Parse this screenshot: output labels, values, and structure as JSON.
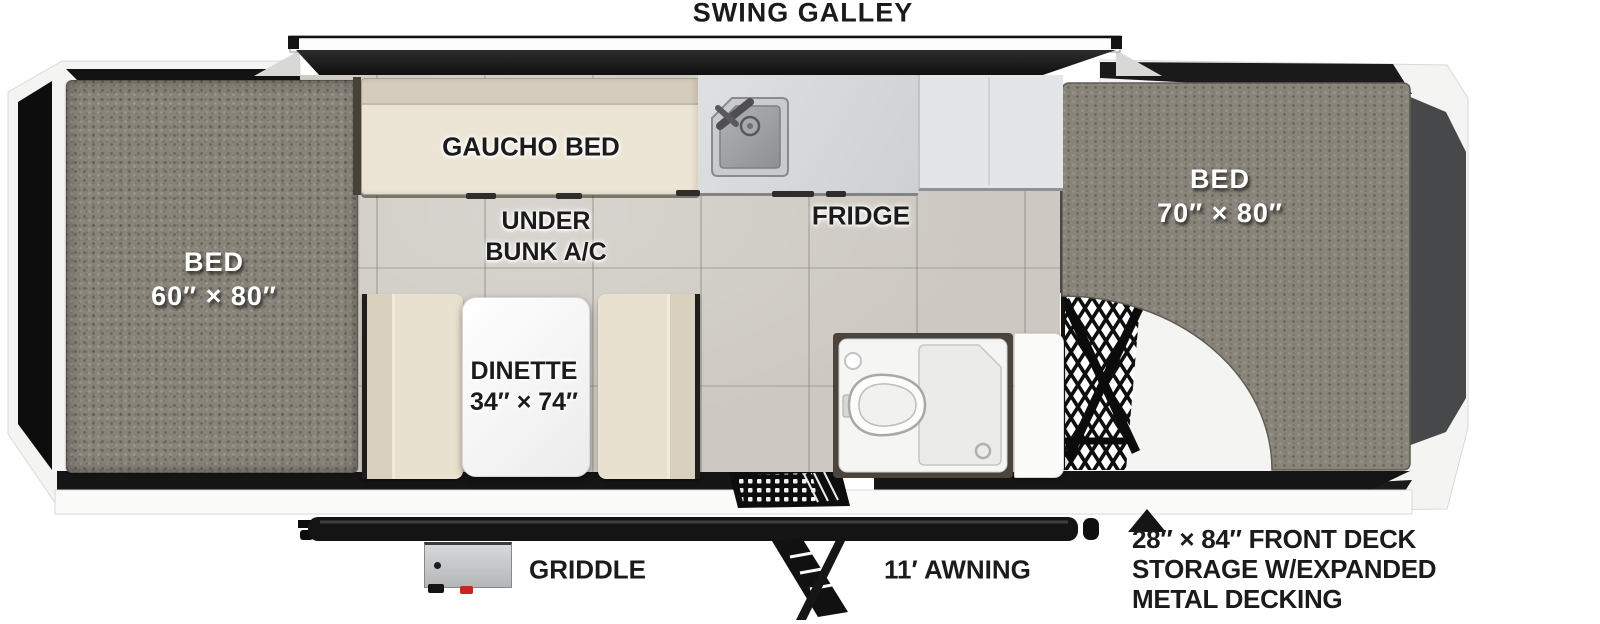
{
  "title": "SWING GALLEY",
  "labels": {
    "front_bed_name": "BED",
    "front_bed_size": "60″ × 80″",
    "rear_bed_name": "BED",
    "rear_bed_size": "70″ × 80″",
    "gaucho_bed": "GAUCHO BED",
    "under_bunk_line1": "UNDER",
    "under_bunk_line2": "BUNK A/C",
    "fridge": "FRIDGE",
    "dinette_name": "DINETTE",
    "dinette_size": "34″ × 74″",
    "griddle": "GRIDDLE",
    "awning": "11′ AWNING",
    "deck_note_line1": "28″ × 84″ FRONT DECK",
    "deck_note_line2": "STORAGE W/EXPANDED",
    "deck_note_line3": "METAL DECKING"
  },
  "icons": {
    "sink": "sink-icon",
    "toilet": "toilet-icon",
    "shower_pan": "shower-pan-icon",
    "entry_step": "entry-step-icon",
    "fold_step": "fold-step-icon",
    "awning_rail": "awning-rail",
    "mesh_decking": "expanded-metal-mesh",
    "note_arrow": "up-triangle-icon"
  },
  "colors": {
    "mattress": "#89847a",
    "cushion": "#e9e1d0",
    "counter": "#d6d7d9",
    "fridge": "#e4e5e7",
    "floor_tile": "#cdc9c2",
    "frame_white": "#f4f4f3",
    "dark": "#151515",
    "rear_panel": "#474849",
    "knob_red": "#c3271d"
  }
}
